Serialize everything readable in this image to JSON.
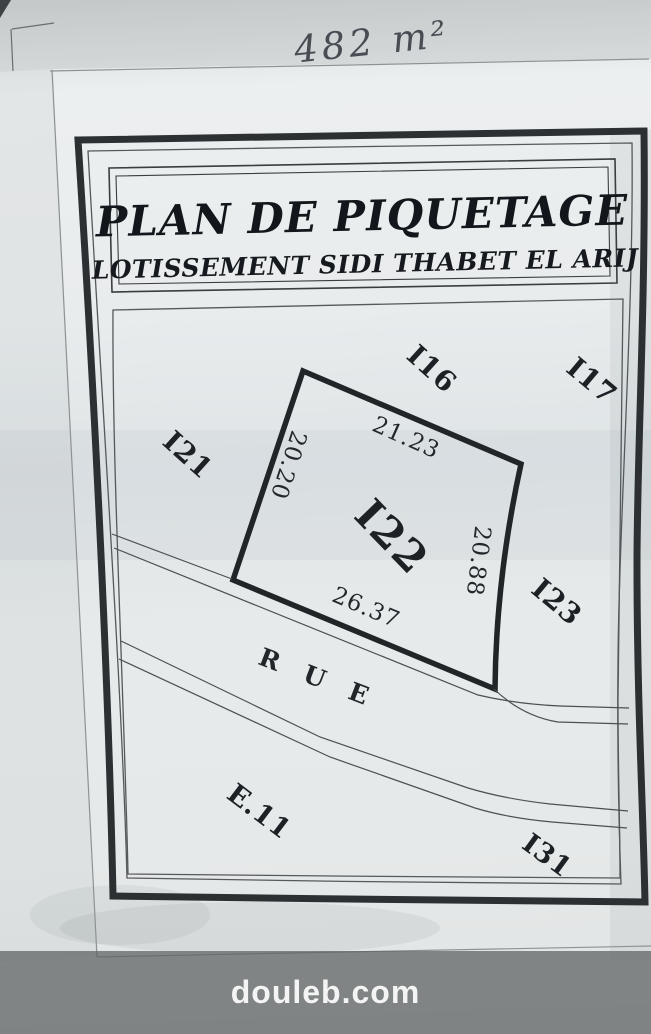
{
  "annotation": {
    "area": "482 m²"
  },
  "title_block": {
    "title": "PLAN DE PIQUETAGE",
    "subtitle": "LOTISSEMENT SIDI THABET  EL ARIJ"
  },
  "plan": {
    "parcel_label": "I22",
    "dim_top": "21.23",
    "dim_left": "20.20",
    "dim_right": "20.88",
    "dim_bottom": "26.37",
    "lot_top": "I16",
    "lot_top_right": "I17",
    "lot_left": "I21",
    "lot_right": "I23",
    "lot_bottom_left": "E.11",
    "lot_bottom_right": "I31",
    "street": "R U E"
  },
  "watermark": {
    "text": "douleb.com"
  },
  "colors": {
    "paper": "#e9eced",
    "frame_ink": "#2c3033",
    "line_ink": "#54585a",
    "text_ink": "#1d2125",
    "watermark_bar": "#87898b",
    "watermark_text": "#f3f4f3"
  }
}
